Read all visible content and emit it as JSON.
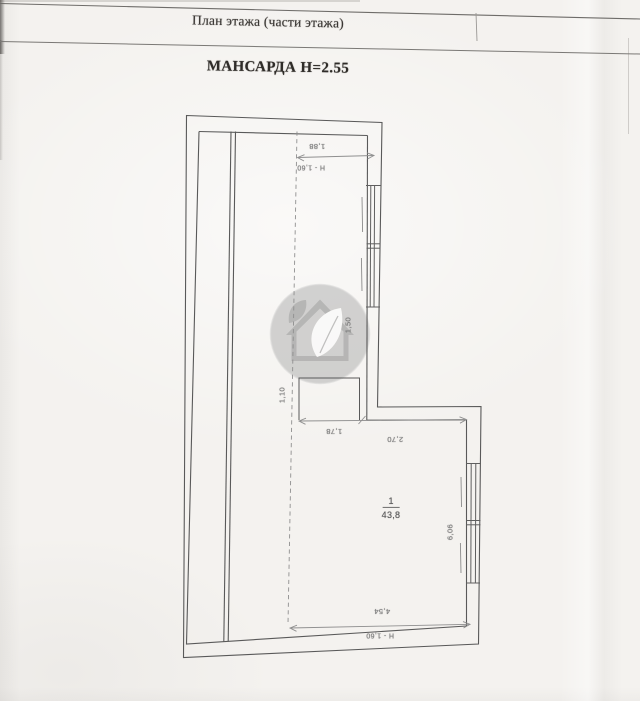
{
  "header": {
    "title": "План этажа (части этажа)",
    "subtitle": "МАНСАРДА Н=2.55"
  },
  "plan": {
    "room": {
      "number": "1",
      "area": "43,8"
    },
    "dims": {
      "top_width": "1,88",
      "top_height_note": "Н - 1,60",
      "window_right": "1,50",
      "niche_height": "1,10",
      "mid_left": "1,78",
      "mid_right": "2,70",
      "right_height": "6,06",
      "bottom_width": "4,54",
      "bottom_height_note": "Н - 1,60"
    }
  },
  "watermark": {
    "icon": "house-with-leaf-logo"
  },
  "colors": {
    "paper": "#f4f2ef",
    "wall_line": "#595959",
    "dim_line": "#8f8f8f",
    "dim_text": "#828282",
    "header_text": "#3a3734",
    "watermark_gray": "#a9a9a9"
  }
}
